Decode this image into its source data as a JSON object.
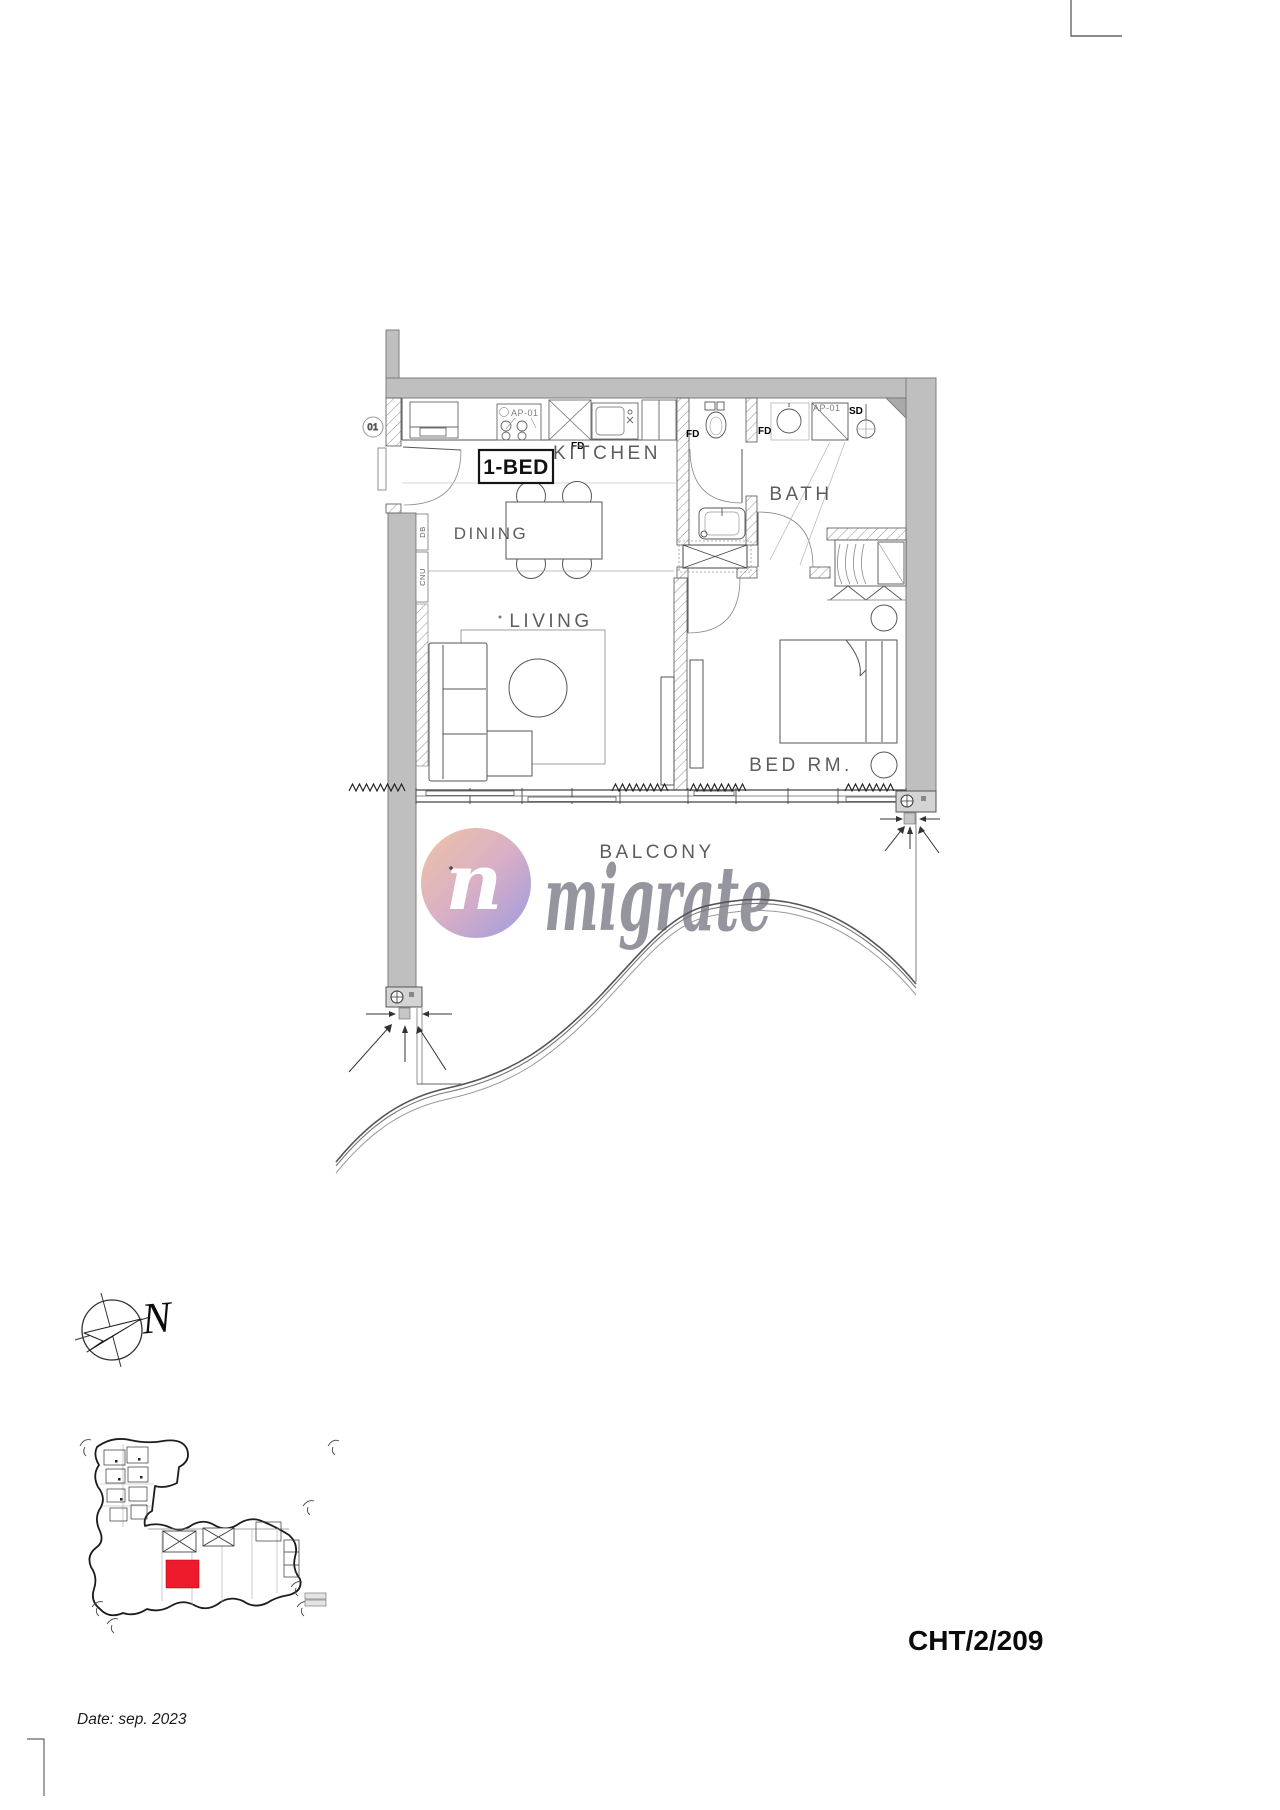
{
  "sheet": {
    "reference_code": "CHT/2/209",
    "date_label": "Date: sep. 2023"
  },
  "watermark": {
    "brand_text": "migrate",
    "logo_letter": "n"
  },
  "compass": {
    "north_label": "N"
  },
  "plan": {
    "unit_type_badge": "1-BED",
    "rooms": {
      "kitchen": "KITCHEN",
      "dining": "DINING",
      "living": "LIVING",
      "bath": "BATH",
      "bedroom": "BED RM.",
      "balcony": "BALCONY"
    },
    "tags": {
      "appliance_kitchen": "AP-01",
      "appliance_bath": "AP-01",
      "floor_drain": "FD",
      "shower_drain": "SD",
      "entry_door": "01",
      "panel_db": "DB",
      "panel_cnu": "CNU"
    }
  },
  "key_plan": {
    "highlight_color": "#ee1b2d"
  },
  "palette": {
    "wall_gray": "#bfbfbf",
    "line_dark": "#3a3a3a",
    "label_gray": "#5d5d5d",
    "watermark_gray": "#8d8d97",
    "logo_gradient_start": "#efc3a3",
    "logo_gradient_end": "#9c9be0"
  }
}
